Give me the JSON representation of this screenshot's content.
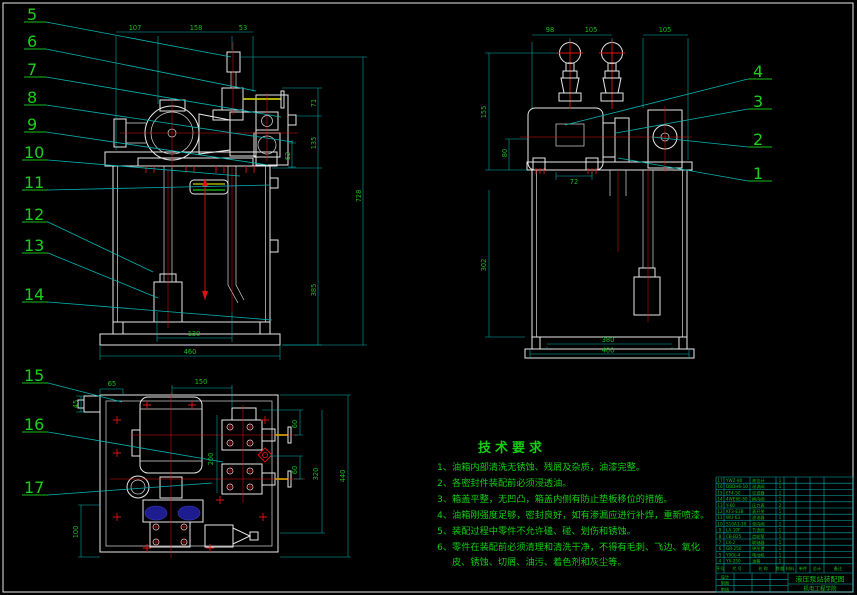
{
  "meta": {
    "app": "cad-drawing",
    "background": "#000000"
  },
  "colors": {
    "line": "#e9e9e9",
    "centerline": "#e31212",
    "dimension": "#00b4b4",
    "text_green": "#18c018",
    "handle_yellow": "#c9c900",
    "pump_blue": "#1d1d8f"
  },
  "callouts": {
    "left": [
      "5",
      "6",
      "7",
      "8",
      "9",
      "10",
      "11",
      "12",
      "13",
      "14"
    ],
    "lower_left": [
      "15",
      "16",
      "17"
    ],
    "right": [
      "4",
      "3",
      "2",
      "1"
    ]
  },
  "dims": {
    "f107": "107",
    "f158": "158",
    "f53": "53",
    "f71": "71",
    "f135": "135",
    "f62": "62",
    "f385": "385",
    "f728": "728",
    "f130": "130",
    "f460": "460",
    "s98": "98",
    "s105a": "105",
    "s105b": "105",
    "s155": "155",
    "s80": "80",
    "s302": "302",
    "s72": "72",
    "s380": "380",
    "s400": "400",
    "t65": "65",
    "t45": "45",
    "t150": "150",
    "t200": "200",
    "t60a": "60",
    "t60b": "60",
    "t320": "320",
    "t440": "440",
    "t100": "100"
  },
  "tech": {
    "title": "技术要求",
    "lines": [
      "1、油箱内部清洗无锈蚀、残屑及杂质，油漆完整。",
      "2、各密封件装配前必须浸透油。",
      "3、箱盖平整，无凹凸，箱盖内侧有防止垫板移位的措施。",
      "4、油箱刚强度足够，密封良好，如有渗漏应进行补焊，重新喷漆。",
      "5、装配过程中零件不允许磕、碰、划伤和锈蚀。",
      "6、零件在装配前必须清理和清洗干净，不得有毛刺、飞边、氧化",
      "皮、锈蚀、切屑、油污、着色剂和灰尘等。"
    ]
  },
  "bom": {
    "headers": [
      "序号",
      "代  号",
      "名  称",
      "数量",
      "材料",
      "单件",
      "总计",
      "备注"
    ],
    "rows": [
      {
        "no": "17",
        "code": "YWZ-80",
        "name": "液位计",
        "qty": "1"
      },
      {
        "no": "16",
        "code": "DBDH6-10",
        "name": "溢流阀",
        "qty": "1"
      },
      {
        "no": "15",
        "code": "EF4-50",
        "name": "空滤器",
        "qty": "1"
      },
      {
        "no": "14",
        "code": "4WE6E-50",
        "name": "换向阀",
        "qty": "1"
      },
      {
        "no": "13",
        "code": "Y-60",
        "name": "压力表",
        "qty": "2"
      },
      {
        "no": "12",
        "code": "KF3-E3B",
        "name": "表开关",
        "qty": "1"
      },
      {
        "no": "11",
        "code": "WU-63",
        "name": "滤油器",
        "qty": "1"
      },
      {
        "no": "10",
        "code": "S10A1-30",
        "name": "单向阀",
        "qty": "1"
      },
      {
        "no": "9",
        "code": "LA-10F",
        "name": "节流阀",
        "qty": "1"
      },
      {
        "no": "8",
        "code": "CB-B25",
        "name": "齿轮泵",
        "qty": "1"
      },
      {
        "no": "7",
        "code": "LX-2",
        "name": "联轴器",
        "qty": "1"
      },
      {
        "no": "6",
        "code": "GR-250",
        "name": "钟形罩",
        "qty": "1"
      },
      {
        "no": "5",
        "code": "Y90L-4",
        "name": "电动机",
        "qty": "1"
      },
      {
        "no": "4",
        "code": "YX-250",
        "name": "油箱",
        "qty": "1"
      }
    ]
  },
  "title_block": {
    "project": "液压泵站装配图",
    "org": "机电工程学院",
    "fields": [
      "设计",
      "制图",
      "审核"
    ]
  }
}
